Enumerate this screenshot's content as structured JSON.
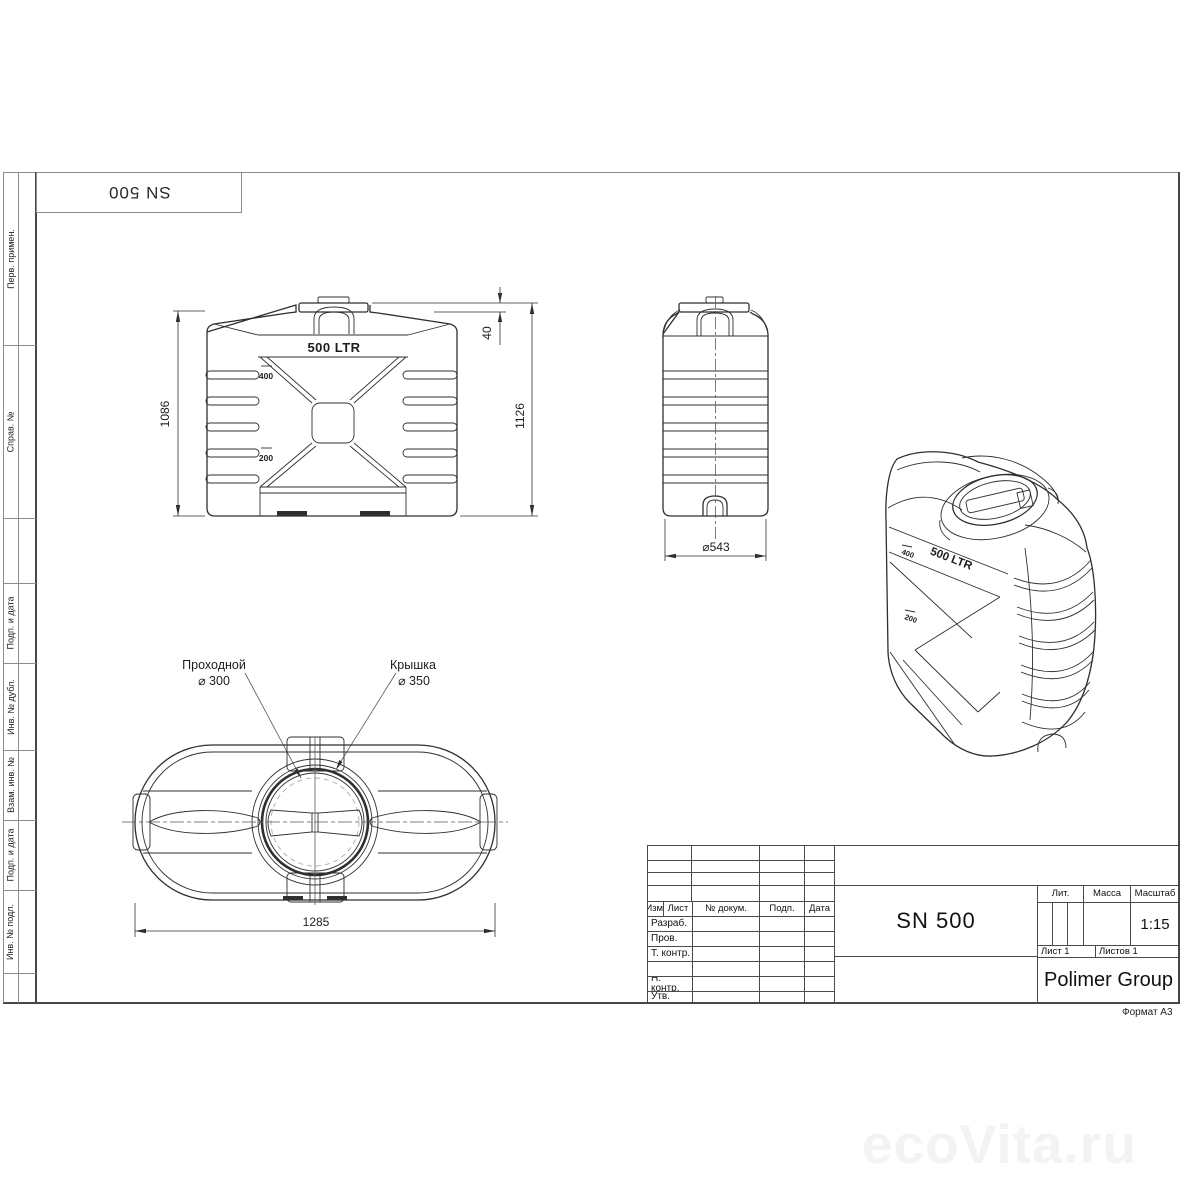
{
  "page": {
    "format_label": "Формат А3",
    "watermark": "ecoVita.ru"
  },
  "stamp_top_left": {
    "label": "SN 500"
  },
  "margin_strip": {
    "items": [
      {
        "label": "Перв. примен."
      },
      {
        "label": "Справ. №"
      },
      {
        "label": "Подп. и дата"
      },
      {
        "label": "Инв. № дубл."
      },
      {
        "label": "Взам. инв. №"
      },
      {
        "label": "Подп. и дата"
      },
      {
        "label": "Инв. № подл."
      }
    ]
  },
  "views": {
    "front": {
      "volume_label": "500 LTR",
      "level_marks": [
        "400",
        "200"
      ],
      "dim_height_body": "1086",
      "dim_height_total": "1126",
      "dim_lid": "40"
    },
    "side": {
      "dim_diameter": "⌀543"
    },
    "iso": {
      "volume_label": "500 LTR",
      "level_marks": [
        "400",
        "200"
      ]
    },
    "top": {
      "callout_pass": {
        "line1": "Проходной",
        "line2": "⌀ 300"
      },
      "callout_lid": {
        "line1": "Крышка",
        "line2": "⌀ 350"
      },
      "dim_length": "1285"
    }
  },
  "title_block": {
    "rev_header": {
      "izm": "Изм.",
      "list": "Лист",
      "doc": "№ докум.",
      "sign": "Подп.",
      "date": "Дата"
    },
    "rows": {
      "razrab": "Разраб.",
      "prov": "Пров.",
      "tkontr": "Т. контр.",
      "nkontr": "Н. контр.",
      "utv": "Утв."
    },
    "title": "SN 500",
    "lit_label": "Лит.",
    "mass_label": "Масса",
    "scale_label": "Масштаб",
    "scale_value": "1:15",
    "sheet": "Лист 1",
    "sheets": "Листов 1",
    "company": "Polimer Group"
  },
  "colors": {
    "line": "#2f2f2f",
    "frame": "#8c8c8c",
    "title_lines": "#4a4a4a",
    "watermark": "#f2f3f5"
  }
}
